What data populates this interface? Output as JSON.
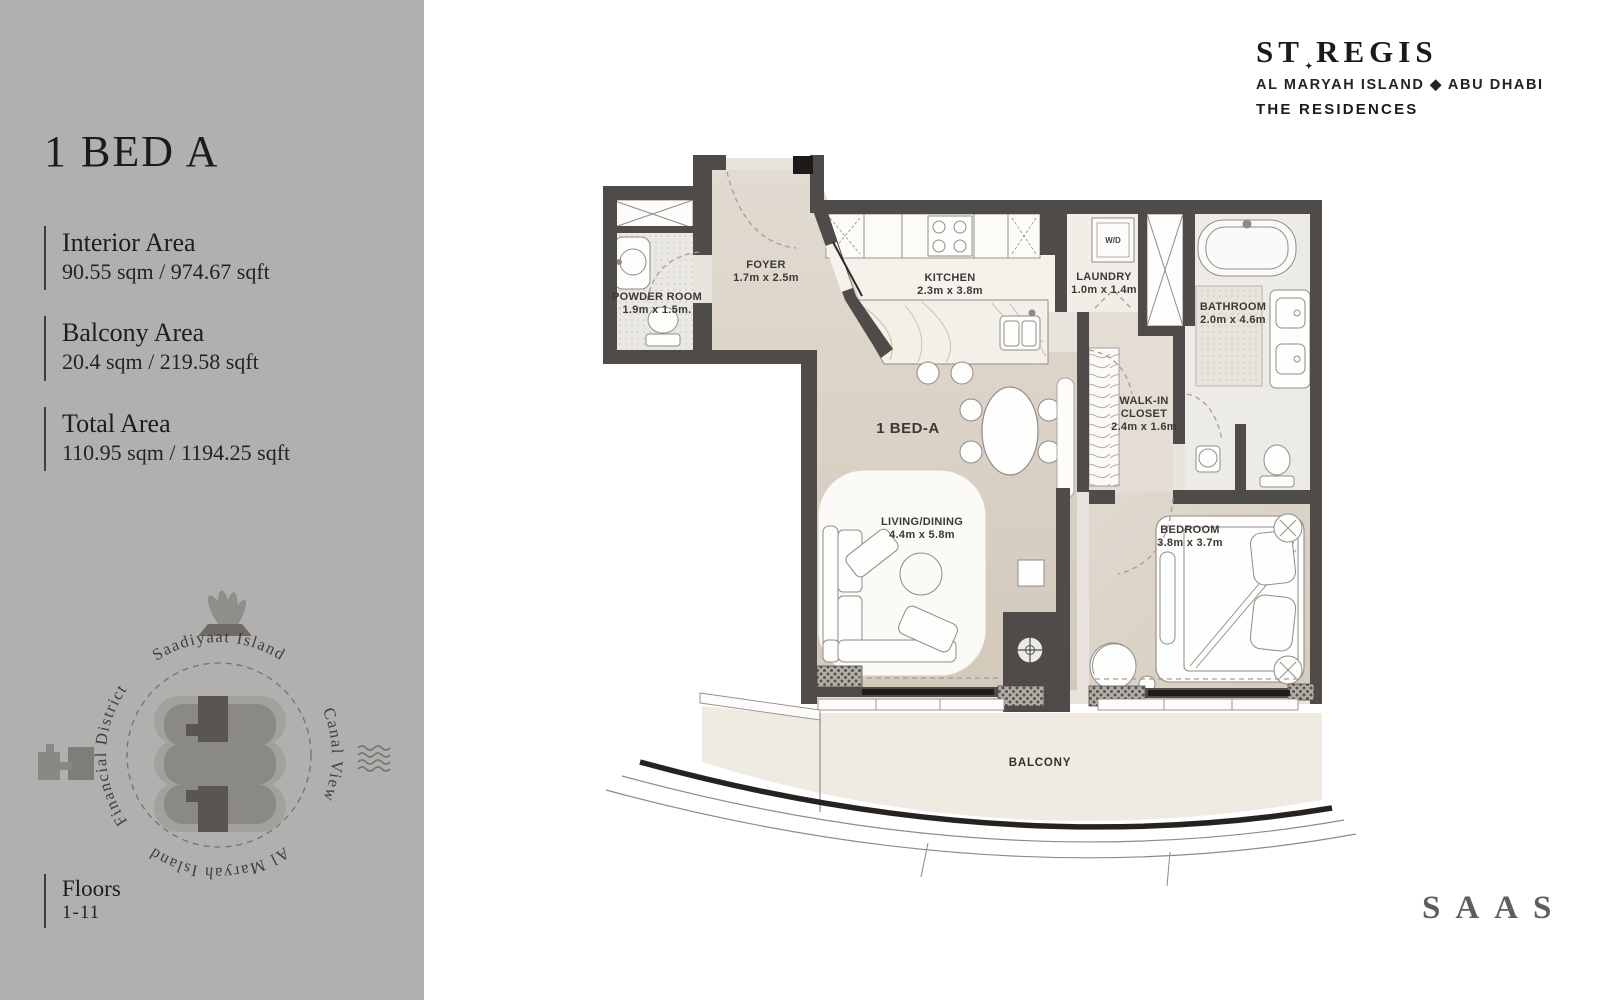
{
  "sidebar": {
    "title": "1 BED A",
    "areas": [
      {
        "label": "Interior Area",
        "value": "90.55 sqm / 974.67 sqft"
      },
      {
        "label": "Balcony Area",
        "value": "20.4 sqm / 219.58 sqft"
      },
      {
        "label": "Total Area",
        "value": "110.95 sqm / 1194.25 sqft"
      }
    ],
    "floors_label": "Floors",
    "floors_value": "1-11",
    "compass": {
      "top": "Saadiyaat Island",
      "left": "Financial District",
      "right": "Canal View",
      "bottom": "Al Maryah Island"
    }
  },
  "brand": {
    "name": "ST REGIS",
    "mark": "✦",
    "location": "AL MARYAH ISLAND ◆ ABU DHABI",
    "division": "THE RESIDENCES"
  },
  "developer_logo": "SAAS",
  "plan": {
    "unit_label": "1 BED-A",
    "washer_label": "W/D",
    "rooms": {
      "powder": {
        "name": "POWDER ROOM",
        "dims": "1.9m x 1.5m."
      },
      "foyer": {
        "name": "FOYER",
        "dims": "1.7m x 2.5m"
      },
      "kitchen": {
        "name": "KITCHEN",
        "dims": "2.3m x 3.8m"
      },
      "laundry": {
        "name": "LAUNDRY",
        "dims": "1.0m x 1.4m"
      },
      "bathroom": {
        "name": "BATHROOM",
        "dims": "2.0m x 4.6m"
      },
      "walkin": {
        "line1": "WALK-IN",
        "line2": "CLOSET",
        "dims": "2.4m x 1.6m"
      },
      "living": {
        "name": "LIVING/DINING",
        "dims": "4.4m x 5.8m"
      },
      "bedroom": {
        "name": "BEDROOM",
        "dims": "3.8m x 3.7m"
      },
      "balcony": {
        "name": "BALCONY"
      }
    }
  },
  "colors": {
    "sidebar_bg": "#b1b0ae",
    "wall": "#4e4b48",
    "floor_beige": "#d7cfc3",
    "floor_light": "#edebe6",
    "balcony_edge": "#26231f"
  }
}
